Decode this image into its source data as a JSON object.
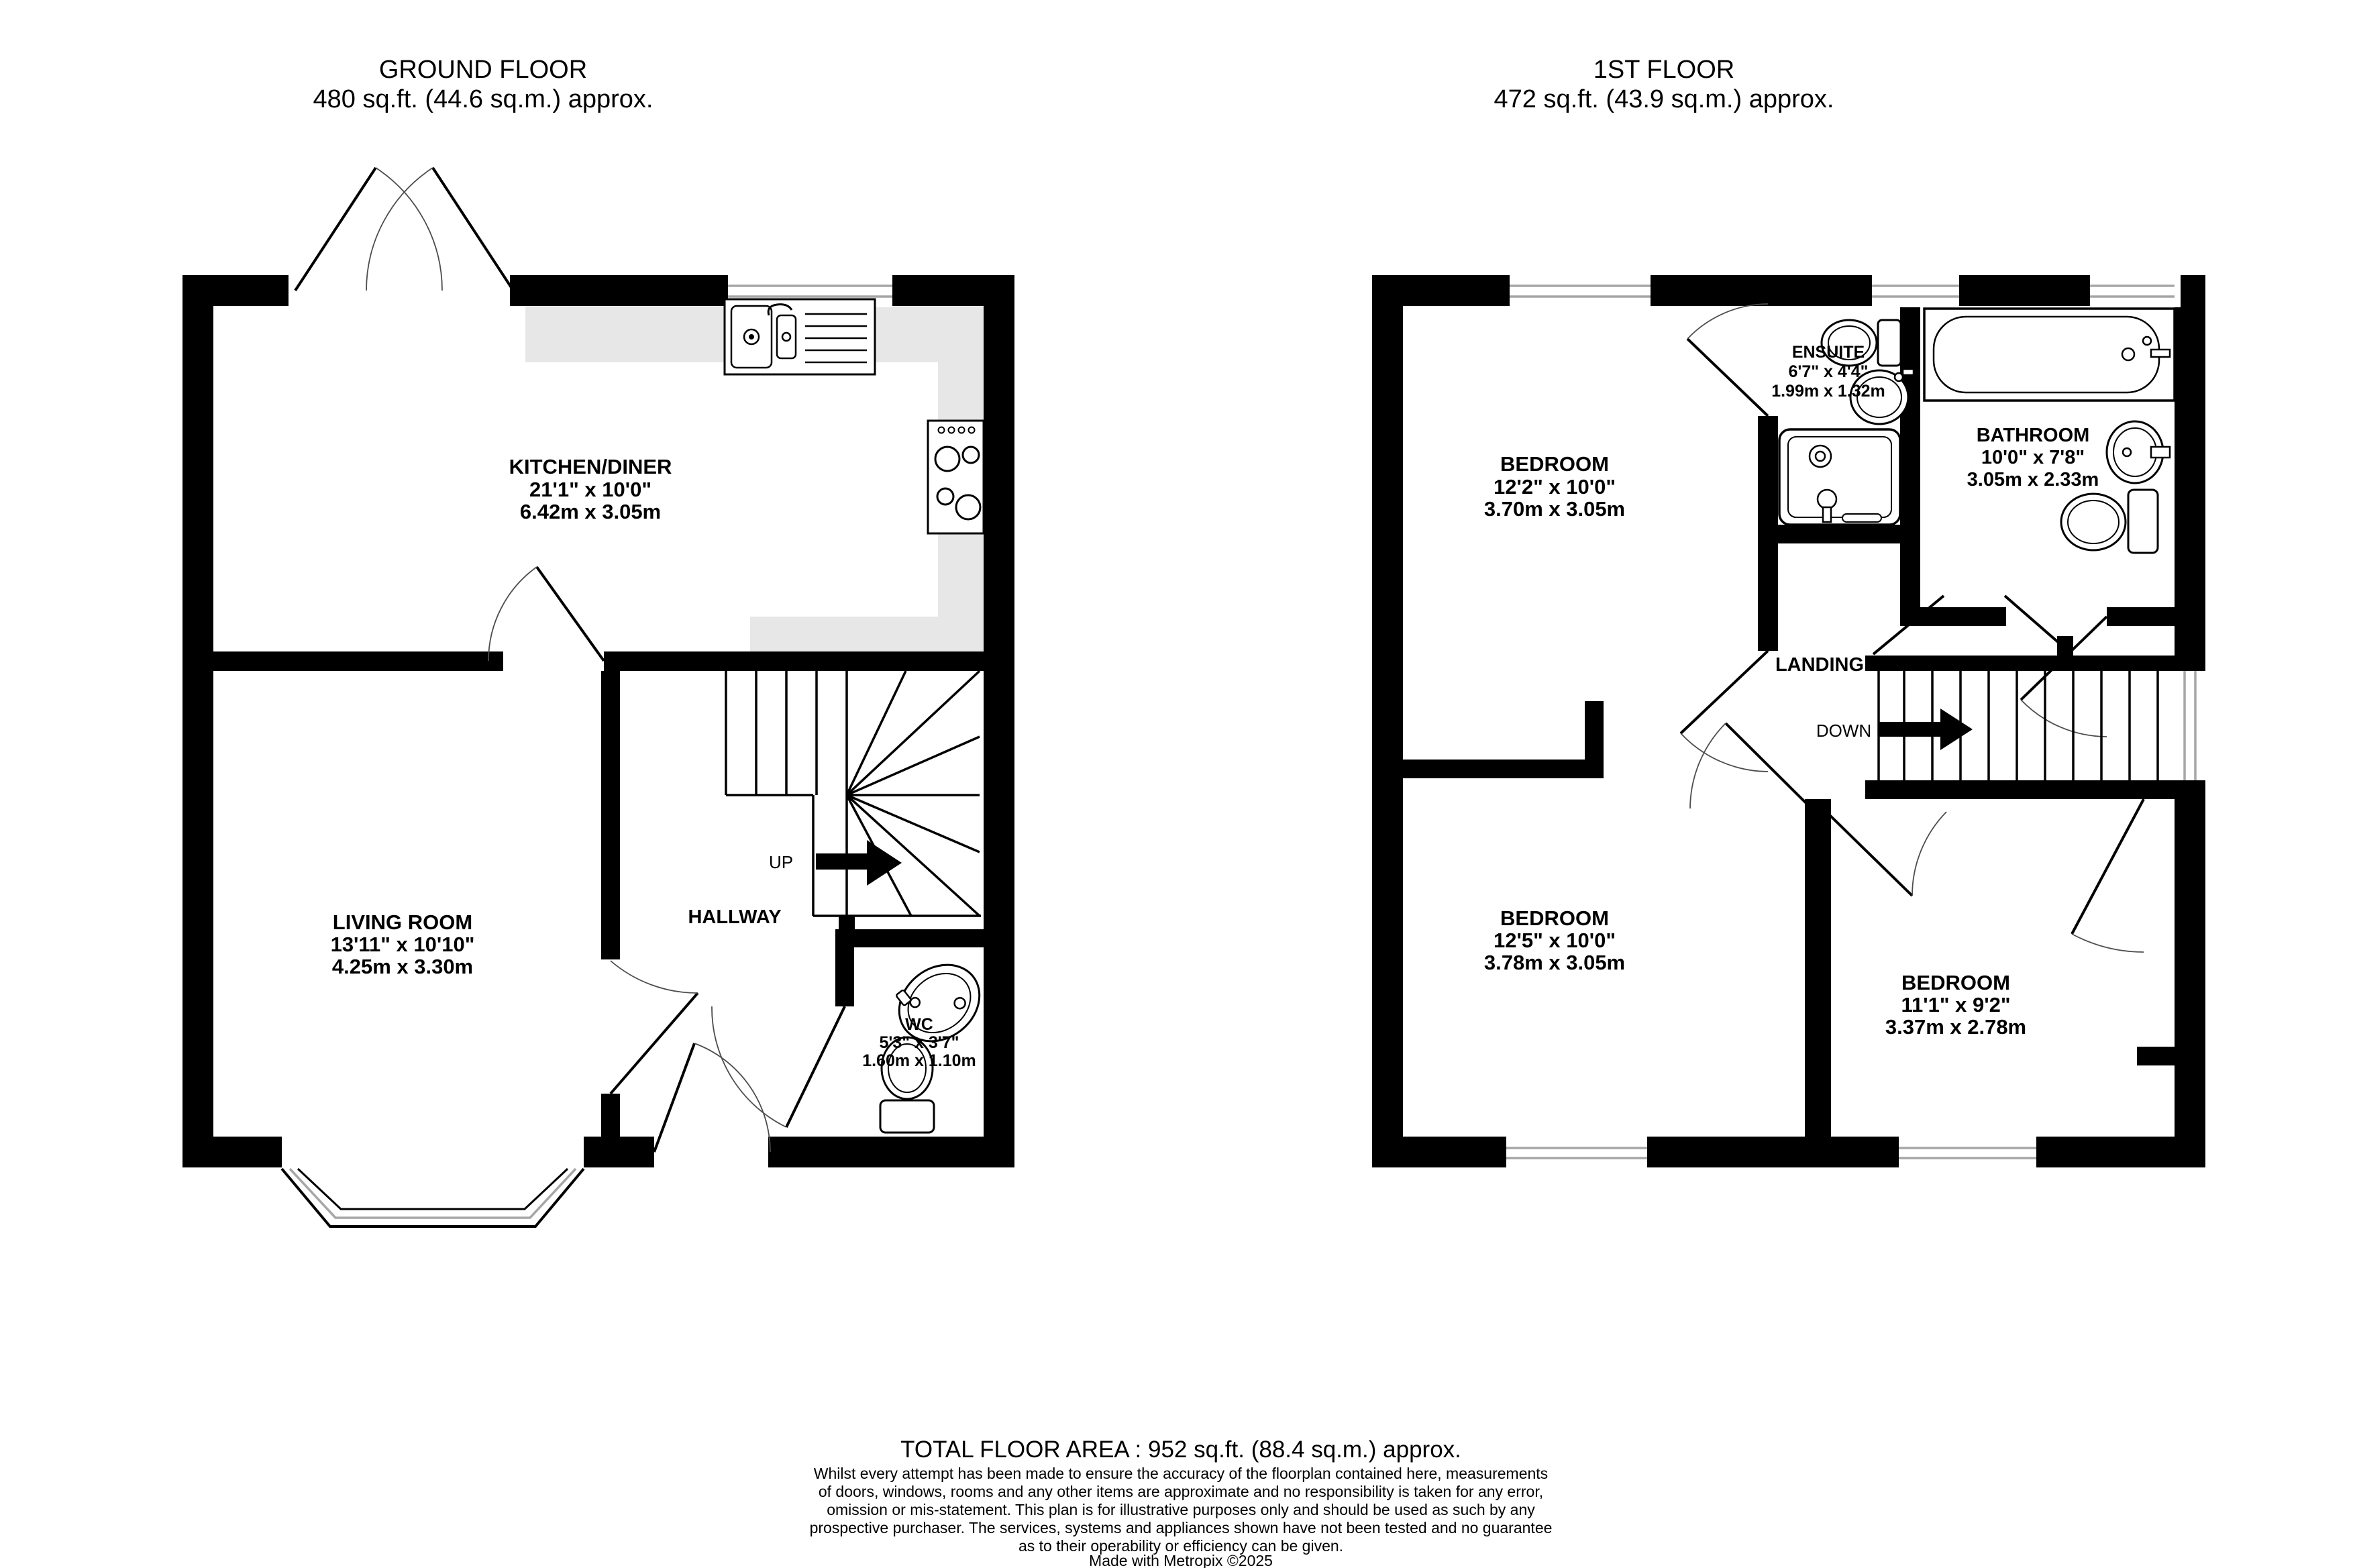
{
  "ground_floor": {
    "title": "GROUND FLOOR",
    "subtitle": "480 sq.ft. (44.6 sq.m.) approx.",
    "kitchen": {
      "name": "KITCHEN/DINER",
      "size_imperial": "21'1\"  x 10'0\"",
      "size_metric": "6.42m  x 3.05m"
    },
    "living_room": {
      "name": "LIVING ROOM",
      "size_imperial": "13'11\"  x 10'10\"",
      "size_metric": "4.25m  x 3.30m"
    },
    "hallway": {
      "name": "HALLWAY"
    },
    "wc": {
      "name": "WC",
      "size_imperial": "5'3\"  x 3'7\"",
      "size_metric": "1.60m  x 1.10m"
    },
    "stairs_label": "UP"
  },
  "first_floor": {
    "title": "1ST FLOOR",
    "subtitle": "472 sq.ft. (43.9 sq.m.) approx.",
    "bedroom1": {
      "name": "BEDROOM",
      "size_imperial": "12'2\"  x 10'0\"",
      "size_metric": "3.70m  x 3.05m"
    },
    "ensuite": {
      "name": "ENSUITE",
      "size_imperial": "6'7\"  x 4'4\"",
      "size_metric": "1.99m  x 1.32m"
    },
    "bathroom": {
      "name": "BATHROOM",
      "size_imperial": "10'0\"  x 7'8\"",
      "size_metric": "3.05m  x 2.33m"
    },
    "landing": {
      "name": "LANDING"
    },
    "bedroom2": {
      "name": "BEDROOM",
      "size_imperial": "12'5\"  x 10'0\"",
      "size_metric": "3.78m  x 3.05m"
    },
    "bedroom3": {
      "name": "BEDROOM",
      "size_imperial": "11'1\"  x 9'2\"",
      "size_metric": "3.37m  x 2.78m"
    },
    "stairs_label": "DOWN"
  },
  "footer": {
    "total_area": "TOTAL FLOOR AREA : 952 sq.ft. (88.4 sq.m.) approx.",
    "disclaimer": [
      "Whilst every attempt has been made to ensure the accuracy of the floorplan contained here, measurements",
      "of doors, windows, rooms and any other items are approximate and no responsibility is taken for any error,",
      "omission or mis-statement. This plan is for illustrative purposes only and should be used as such by any",
      "prospective purchaser. The services, systems and appliances shown have not been tested and no guarantee",
      "as to their operability or efficiency can be given."
    ],
    "credit": "Made with Metropix ©2025"
  },
  "colors": {
    "wall": "#000000",
    "counter": "#e7e7e7",
    "window_line": "#a6a6a6",
    "text": "#000000",
    "background": "#ffffff"
  }
}
